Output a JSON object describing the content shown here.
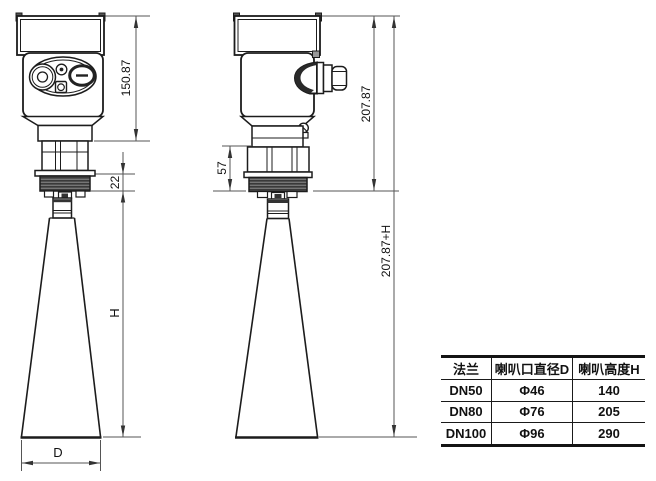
{
  "drawing": {
    "front_view": {
      "dim_head_height": "150.87",
      "dim_thread_height": "22",
      "dim_horn_height": "H",
      "dim_horn_diameter": "D"
    },
    "side_view": {
      "dim_head_height": "207.87",
      "dim_neck_height": "57",
      "dim_total_height": "207.87+H"
    },
    "colors": {
      "outline": "#1c1c1c",
      "dimension_line": "#555555",
      "thread_fill": "#3a3a3a",
      "background": "#ffffff"
    }
  },
  "spec_table": {
    "columns": [
      "法兰",
      "喇叭口直径D",
      "喇叭高度H"
    ],
    "rows": [
      [
        "DN50",
        "Φ46",
        "140"
      ],
      [
        "DN80",
        "Φ76",
        "205"
      ],
      [
        "DN100",
        "Φ96",
        "290"
      ]
    ]
  }
}
